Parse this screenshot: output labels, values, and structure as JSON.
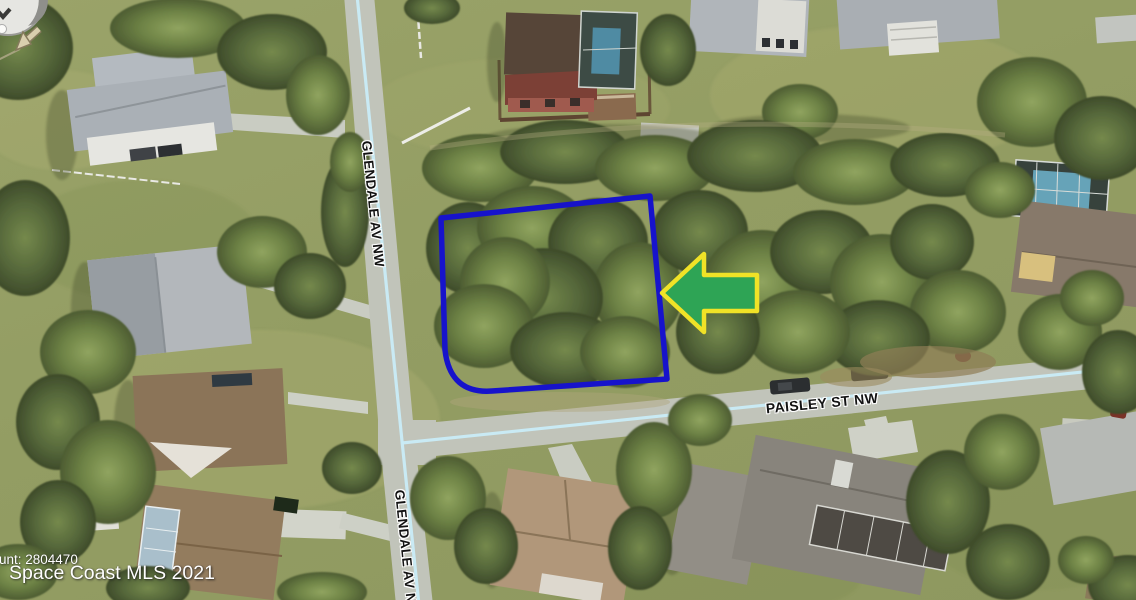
{
  "image": {
    "type": "aerial-satellite-photo",
    "subject": "Vacant corner lot outlined in blue at Glendale Av NW and Paisley St NW"
  },
  "streets": {
    "glendale_top": "GLENDALE AV NW",
    "glendale_bottom": "GLENDALE AV NW",
    "paisley": "PAISLEY ST NW"
  },
  "watermark": {
    "line1": "unt: 2804470",
    "line2": "Space Coast MLS 2021"
  },
  "colors": {
    "lot_outline": "#1713CB",
    "arrow_fill": "#2EA455",
    "arrow_border": "#F0E227",
    "road_centerline": "#C9ECF7",
    "label_text": "#121212",
    "label_halo": "#FFFFFF",
    "watermark_text": "#FFFFFF"
  },
  "icons": {
    "compass": "compass-rose-icon",
    "pointer": "lot-pointer-arrow-icon"
  }
}
